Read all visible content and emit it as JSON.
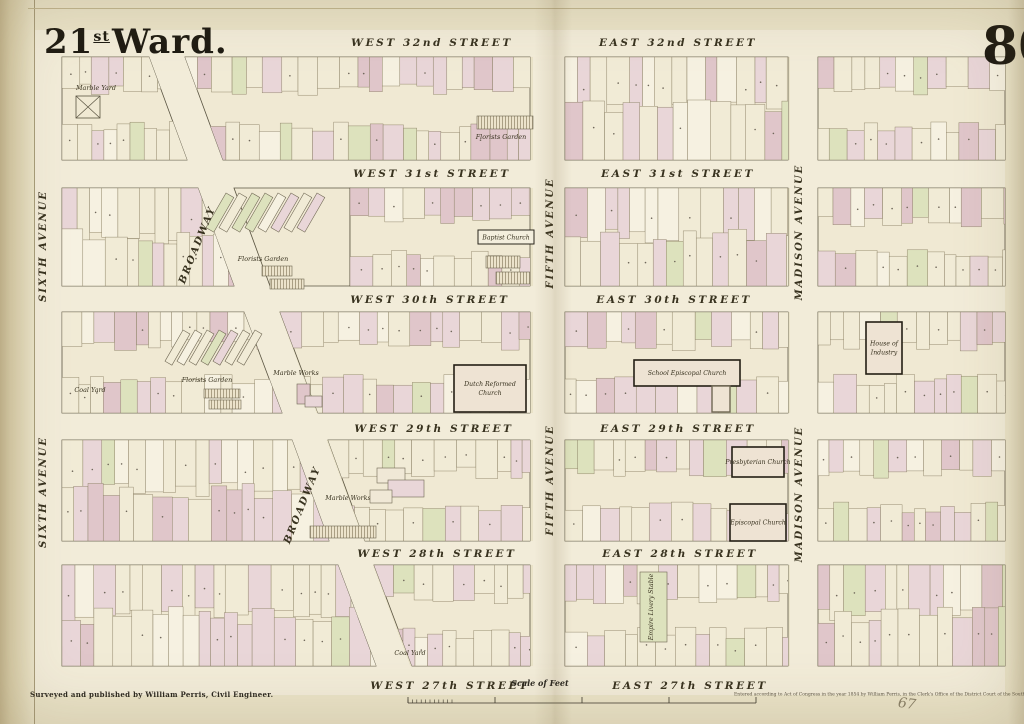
{
  "page": {
    "title": {
      "number": "21",
      "ordinal": "st",
      "rest": "Ward."
    },
    "plate_number": "80"
  },
  "footer": {
    "credit": "Surveyed and published by William Perris, Civil Engineer.",
    "scale_label": "Scale of Feet",
    "copyright": "Entered according to Act of Congress in the year 1854 by William Perris, in the Clerk's Office of the District Court of the Southern District of New York",
    "pencil_mark": "67"
  },
  "colors": {
    "paper": "#eae3c8",
    "street": "#f2ecd9",
    "block": "#f0e9d3",
    "ink": "#2c2820",
    "lot_stroke": "#8d8266",
    "block_stroke": "#5a5442",
    "pink": "#e9d6d8",
    "pink_deep": "#e0c6ca",
    "green": "#dde2bd",
    "cream": "#f1ebd6",
    "white": "#f6f1e1"
  },
  "streets": [
    {
      "west_label": "WEST 32nd STREET",
      "east_label": "EAST 32nd STREET",
      "west_x": 432,
      "east_x": 678,
      "y_label": 46,
      "y_top": 30,
      "y_bottom": 57
    },
    {
      "west_label": "WEST 31st STREET",
      "east_label": "EAST 31st STREET",
      "west_x": 432,
      "east_x": 678,
      "y_label": 177,
      "y_top": 160,
      "y_bottom": 188
    },
    {
      "west_label": "WEST 30th STREET",
      "east_label": "EAST 30th STREET",
      "west_x": 430,
      "east_x": 674,
      "y_label": 303,
      "y_top": 286,
      "y_bottom": 312
    },
    {
      "west_label": "WEST 29th STREET",
      "east_label": "EAST 29th STREET",
      "west_x": 434,
      "east_x": 678,
      "y_label": 432,
      "y_top": 413,
      "y_bottom": 440
    },
    {
      "west_label": "WEST 28th STREET",
      "east_label": "EAST 28th STREET",
      "west_x": 437,
      "east_x": 680,
      "y_label": 557,
      "y_top": 541,
      "y_bottom": 565
    },
    {
      "west_label": "WEST 27th STREET",
      "east_label": "EAST 27th STREET",
      "west_x": 450,
      "east_x": 690,
      "y_label": 689,
      "y_top": 666,
      "y_bottom": 695
    }
  ],
  "avenues": [
    {
      "name": "SIXTH AVENUE",
      "labels": [
        {
          "x": 46,
          "y": 246,
          "angle": -90
        },
        {
          "x": 46,
          "y": 492,
          "angle": -90
        }
      ]
    },
    {
      "name": "BROADWAY",
      "labels": [
        {
          "x": 200,
          "y": 246,
          "angle": -68
        },
        {
          "x": 305,
          "y": 506,
          "angle": -68
        }
      ]
    },
    {
      "name": "FIFTH AVENUE",
      "labels": [
        {
          "x": 553,
          "y": 233,
          "angle": -90
        },
        {
          "x": 553,
          "y": 480,
          "angle": -90
        }
      ]
    },
    {
      "name": "MADISON AVENUE",
      "labels": [
        {
          "x": 802,
          "y": 232,
          "angle": -90
        },
        {
          "x": 802,
          "y": 494,
          "angle": -90
        }
      ]
    }
  ],
  "broadway_band": [
    [
      148,
      55
    ],
    [
      184,
      55
    ],
    [
      421,
      695
    ],
    [
      385,
      695
    ]
  ],
  "avenue_bands": [
    {
      "x": 35,
      "w": 27
    },
    {
      "x": 533,
      "w": 32
    },
    {
      "x": 790,
      "w": 28
    }
  ],
  "map_area": {
    "x": 35,
    "y": 30,
    "w": 970,
    "h": 665
  },
  "blocks": [
    {
      "id": "w32-6th-bwy",
      "poly": [
        [
          62,
          57
        ],
        [
          149,
          57
        ],
        [
          187,
          160
        ],
        [
          62,
          160
        ]
      ],
      "density": "strips"
    },
    {
      "id": "w32-bwy-5th",
      "poly": [
        [
          185,
          57
        ],
        [
          530,
          57
        ],
        [
          530,
          160
        ],
        [
          223,
          160
        ]
      ],
      "density": "strips"
    },
    {
      "id": "e32-5th-mad",
      "poly": [
        [
          565,
          57
        ],
        [
          788,
          57
        ],
        [
          788,
          160
        ],
        [
          565,
          160
        ]
      ],
      "density": "full"
    },
    {
      "id": "e32-mad",
      "poly": [
        [
          818,
          57
        ],
        [
          1005,
          57
        ],
        [
          1005,
          160
        ],
        [
          818,
          160
        ]
      ],
      "density": "strips"
    },
    {
      "id": "w31-6th-bwy",
      "poly": [
        [
          62,
          188
        ],
        [
          198,
          188
        ],
        [
          234,
          286
        ],
        [
          62,
          286
        ]
      ],
      "density": "full"
    },
    {
      "id": "w31-bwy-tri",
      "poly": [
        [
          234,
          188
        ],
        [
          350,
          188
        ],
        [
          350,
          286
        ],
        [
          270,
          286
        ]
      ],
      "density": "none"
    },
    {
      "id": "w31-bwy-5th",
      "poly": [
        [
          350,
          188
        ],
        [
          530,
          188
        ],
        [
          530,
          286
        ],
        [
          350,
          286
        ]
      ],
      "density": "strips"
    },
    {
      "id": "e31-5th-mad",
      "poly": [
        [
          565,
          188
        ],
        [
          788,
          188
        ],
        [
          788,
          286
        ],
        [
          565,
          286
        ]
      ],
      "density": "full"
    },
    {
      "id": "e31-mad",
      "poly": [
        [
          818,
          188
        ],
        [
          1005,
          188
        ],
        [
          1005,
          286
        ],
        [
          818,
          286
        ]
      ],
      "density": "strips"
    },
    {
      "id": "w30-6th-bwy",
      "poly": [
        [
          62,
          312
        ],
        [
          244,
          312
        ],
        [
          282,
          413
        ],
        [
          62,
          413
        ]
      ],
      "density": "strips"
    },
    {
      "id": "w30-bwy-5th",
      "poly": [
        [
          280,
          312
        ],
        [
          530,
          312
        ],
        [
          530,
          413
        ],
        [
          318,
          413
        ]
      ],
      "density": "strips"
    },
    {
      "id": "e30-5th-mad",
      "poly": [
        [
          565,
          312
        ],
        [
          788,
          312
        ],
        [
          788,
          413
        ],
        [
          565,
          413
        ]
      ],
      "density": "strips"
    },
    {
      "id": "e30-mad",
      "poly": [
        [
          818,
          312
        ],
        [
          1005,
          312
        ],
        [
          1005,
          413
        ],
        [
          818,
          413
        ]
      ],
      "density": "strips"
    },
    {
      "id": "w29-6th-bwy",
      "poly": [
        [
          62,
          440
        ],
        [
          292,
          440
        ],
        [
          329,
          541
        ],
        [
          62,
          541
        ]
      ],
      "density": "full"
    },
    {
      "id": "w29-bwy-5th",
      "poly": [
        [
          328,
          440
        ],
        [
          530,
          440
        ],
        [
          530,
          541
        ],
        [
          365,
          541
        ]
      ],
      "density": "strips"
    },
    {
      "id": "e29-5th-mad",
      "poly": [
        [
          565,
          440
        ],
        [
          788,
          440
        ],
        [
          788,
          541
        ],
        [
          565,
          541
        ]
      ],
      "density": "strips"
    },
    {
      "id": "e29-mad",
      "poly": [
        [
          818,
          440
        ],
        [
          1005,
          440
        ],
        [
          1005,
          541
        ],
        [
          818,
          541
        ]
      ],
      "density": "strips"
    },
    {
      "id": "w28-6th-bwy",
      "poly": [
        [
          62,
          565
        ],
        [
          338,
          565
        ],
        [
          376,
          666
        ],
        [
          62,
          666
        ]
      ],
      "density": "full"
    },
    {
      "id": "w28-bwy-5th",
      "poly": [
        [
          374,
          565
        ],
        [
          530,
          565
        ],
        [
          530,
          666
        ],
        [
          412,
          666
        ]
      ],
      "density": "strips"
    },
    {
      "id": "e28-5th-mad",
      "poly": [
        [
          565,
          565
        ],
        [
          788,
          565
        ],
        [
          788,
          666
        ],
        [
          565,
          666
        ]
      ],
      "density": "strips"
    },
    {
      "id": "e28-mad",
      "poly": [
        [
          818,
          565
        ],
        [
          1005,
          565
        ],
        [
          1005,
          666
        ],
        [
          818,
          666
        ]
      ],
      "density": "full"
    }
  ],
  "landmarks": [
    {
      "type": "label",
      "text": "Marble Yard",
      "x": 96,
      "y": 90
    },
    {
      "type": "xbox",
      "x": 76,
      "y": 96,
      "w": 24,
      "h": 22
    },
    {
      "type": "hatched",
      "x": 477,
      "y": 116,
      "w": 56,
      "h": 13
    },
    {
      "type": "label",
      "text": "Florists Garden",
      "x": 501,
      "y": 139
    },
    {
      "type": "boxed",
      "text": "Baptist Church",
      "x": 478,
      "y": 230,
      "w": 56,
      "h": 14
    },
    {
      "type": "diagrows",
      "x": 226,
      "y": 193,
      "count": 8,
      "step": 13,
      "rw": 9,
      "rh": 40,
      "angle": 30
    },
    {
      "type": "label",
      "text": "Florists Garden",
      "x": 263,
      "y": 261
    },
    {
      "type": "hatched",
      "x": 262,
      "y": 266,
      "w": 30,
      "h": 10
    },
    {
      "type": "hatched",
      "x": 270,
      "y": 279,
      "w": 34,
      "h": 10
    },
    {
      "type": "hatched",
      "x": 486,
      "y": 256,
      "w": 34,
      "h": 12
    },
    {
      "type": "hatched",
      "x": 496,
      "y": 272,
      "w": 34,
      "h": 12
    },
    {
      "type": "diagrows",
      "x": 183,
      "y": 330,
      "count": 7,
      "step": 12,
      "rw": 8,
      "rh": 36,
      "angle": 30
    },
    {
      "type": "label",
      "text": "Florists Garden",
      "x": 207,
      "y": 382
    },
    {
      "type": "label",
      "text": "Coal Yard",
      "x": 90,
      "y": 392
    },
    {
      "type": "hatched",
      "x": 204,
      "y": 389,
      "w": 36,
      "h": 9
    },
    {
      "type": "hatched",
      "x": 209,
      "y": 400,
      "w": 32,
      "h": 9
    },
    {
      "type": "label",
      "text": "Marble Works",
      "x": 296,
      "y": 375
    },
    {
      "type": "rect",
      "x": 297,
      "y": 384,
      "w": 13,
      "h": 20,
      "fill": "#e0c6ca"
    },
    {
      "type": "rect",
      "x": 305,
      "y": 396,
      "w": 17,
      "h": 11,
      "fill": "#e9d6d8"
    },
    {
      "type": "building",
      "lines": [
        "Dutch Reformed",
        "Church"
      ],
      "x": 454,
      "y": 365,
      "w": 72,
      "h": 47
    },
    {
      "type": "building",
      "lines": [
        "School   Episcopal Church"
      ],
      "x": 634,
      "y": 360,
      "w": 106,
      "h": 26
    },
    {
      "type": "rect",
      "x": 712,
      "y": 386,
      "w": 18,
      "h": 26,
      "fill": "#eee3d3",
      "thick": true
    },
    {
      "type": "building",
      "lines": [
        "House of",
        "Industry"
      ],
      "x": 866,
      "y": 322,
      "w": 36,
      "h": 52
    },
    {
      "type": "building",
      "lines": [
        "Presbyterian Church"
      ],
      "x": 732,
      "y": 447,
      "w": 52,
      "h": 30
    },
    {
      "type": "building",
      "lines": [
        "Episcopal Church"
      ],
      "x": 730,
      "y": 504,
      "w": 56,
      "h": 37
    },
    {
      "type": "label",
      "text": "Marble Works",
      "x": 348,
      "y": 500
    },
    {
      "type": "rect",
      "x": 377,
      "y": 468,
      "w": 28,
      "h": 15,
      "fill": "#f0e8d6"
    },
    {
      "type": "rect",
      "x": 388,
      "y": 480,
      "w": 36,
      "h": 17,
      "fill": "#e9d6d8"
    },
    {
      "type": "rect",
      "x": 370,
      "y": 490,
      "w": 22,
      "h": 13,
      "fill": "#f0e8d6"
    },
    {
      "type": "hatched",
      "x": 310,
      "y": 526,
      "w": 66,
      "h": 12
    },
    {
      "type": "rect",
      "x": 640,
      "y": 572,
      "w": 27,
      "h": 70,
      "fill": "#dde2bd"
    },
    {
      "type": "vlabel",
      "text": "Empire Livery Stable",
      "x": 653,
      "y": 607
    },
    {
      "type": "label",
      "text": "Coal Yard",
      "x": 410,
      "y": 655
    }
  ],
  "scale_bar": {
    "x1": 408,
    "x2": 756,
    "y": 703,
    "majors": 5,
    "minor_end": 452
  }
}
